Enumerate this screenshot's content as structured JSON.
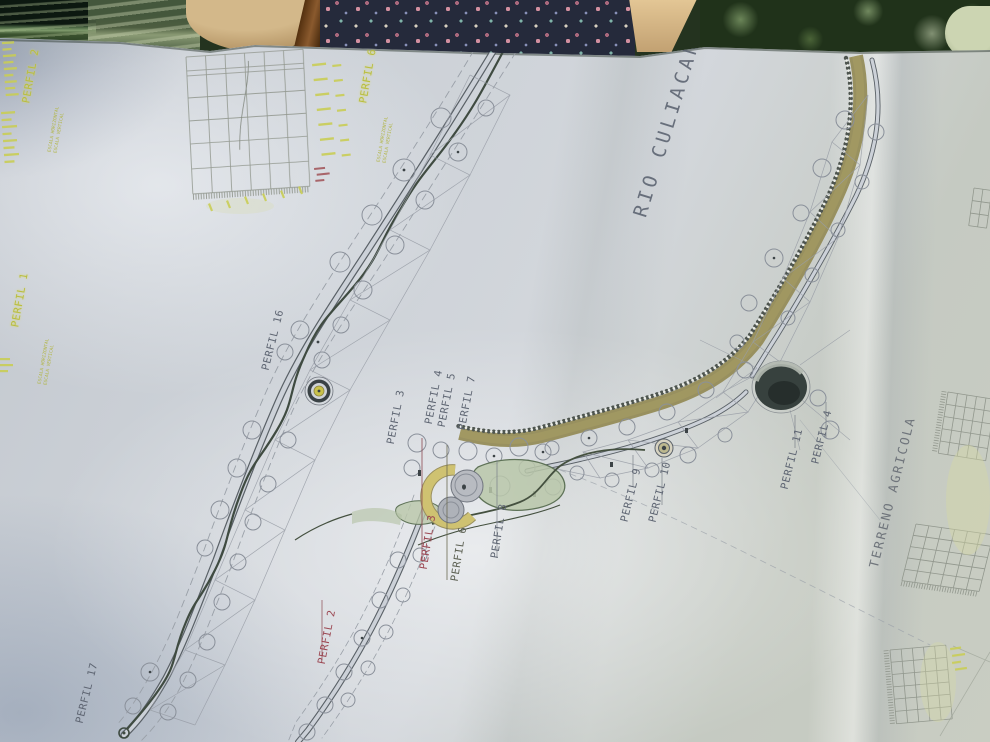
{
  "plan": {
    "river_label": "RIO CULIACAN",
    "land_label": "TERRENO AGRICOLA",
    "profile_labels": {
      "p2_top": "PERFIL 2",
      "p1": "PERFIL 1",
      "p6_top": "PERFIL 6",
      "p16": "PERFIL 16",
      "p3_plan": "PERFIL 3",
      "p4_plan": "PERFIL 4",
      "p5_plan": "PERFIL 5",
      "p7_plan": "PERFIL 7",
      "p3_section": "PERFIL 3",
      "p6_section": "PERFIL 6",
      "p8_section": "PERFIL 8",
      "p9": "PERFIL 9",
      "p10": "PERFIL 10",
      "p11": "PERFIL 11",
      "p4_right": "PERFIL 4",
      "p2_section": "PERFIL 2",
      "p17": "PERFIL 17"
    },
    "scale_notes": {
      "line1": "ESCALA HORIZONTAL",
      "line2": "ESCALA VERTICAL"
    },
    "colors": {
      "paper": "#ccd1d8",
      "riverbank_fill": "#958c58",
      "highlight_yellow": "#c9cd55",
      "label_red": "#9c4752",
      "label_gray": "#5f6673",
      "lawn_green": "#b9c7a9",
      "sand_yellow": "#cfc271",
      "ink": "#858b94"
    }
  }
}
